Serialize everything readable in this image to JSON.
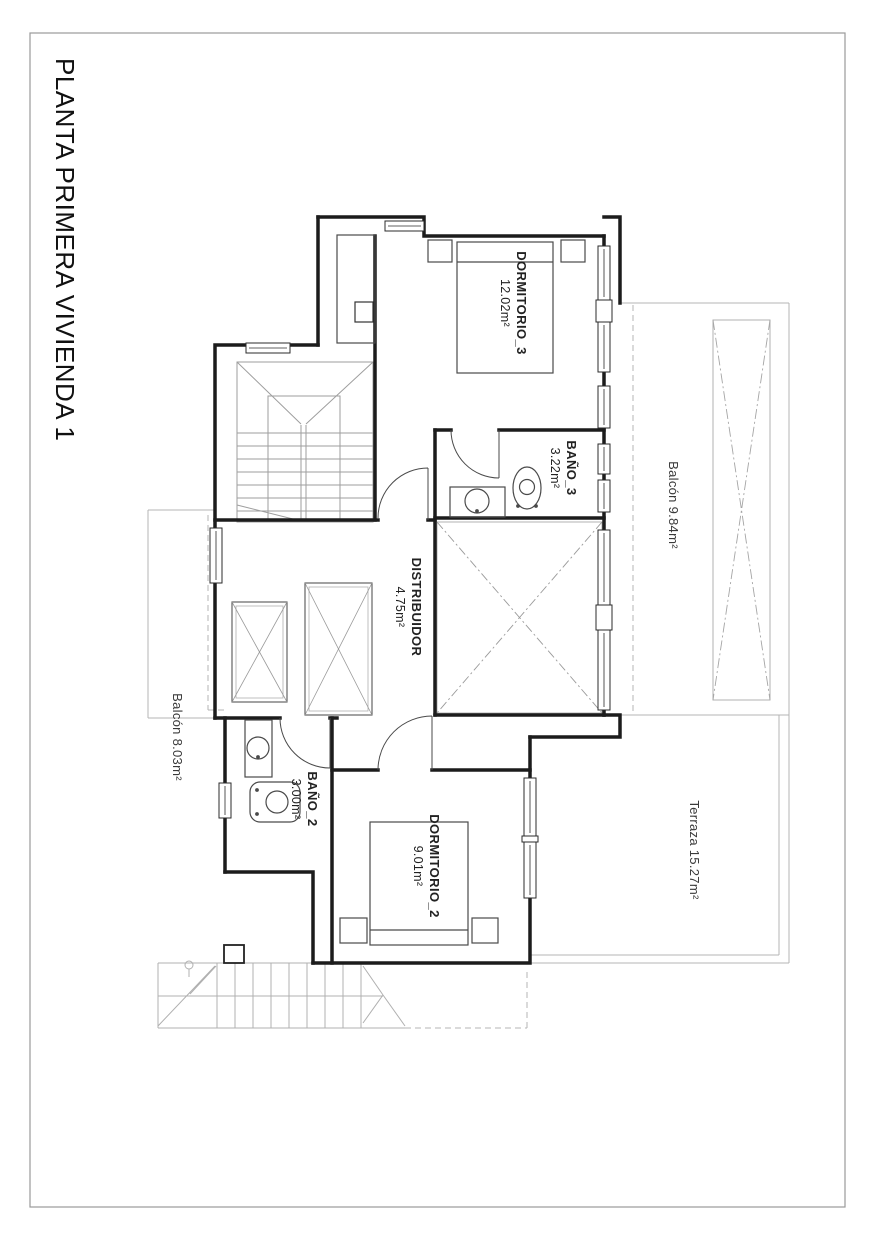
{
  "page": {
    "title": "PLANTA PRIMERA VIVIENDA 1"
  },
  "rooms": {
    "dormitorio3": {
      "name": "DORMITORIO_3",
      "area": "12.02m²"
    },
    "bano3": {
      "name": "BAÑO_3",
      "area": "3.22m²"
    },
    "distribuidor": {
      "name": "DISTRIBUIDOR",
      "area": "4.75m²"
    },
    "bano2": {
      "name": "BAÑO_2",
      "area": "3.00m²"
    },
    "dormitorio2": {
      "name": "DORMITORIO_2",
      "area": "9.01m²"
    },
    "balconRight": {
      "label": "Balcón 9.84m²"
    },
    "balconLeft": {
      "label": "Balcón 8.03m²"
    },
    "terraza": {
      "label": "Terraza 15.27m²"
    }
  },
  "colors": {
    "wall": "#1c1c1c",
    "furniture": "#4a4a4a",
    "light": "#b4b4b4",
    "stairs": "#9e9e9e",
    "text": "#222222"
  }
}
